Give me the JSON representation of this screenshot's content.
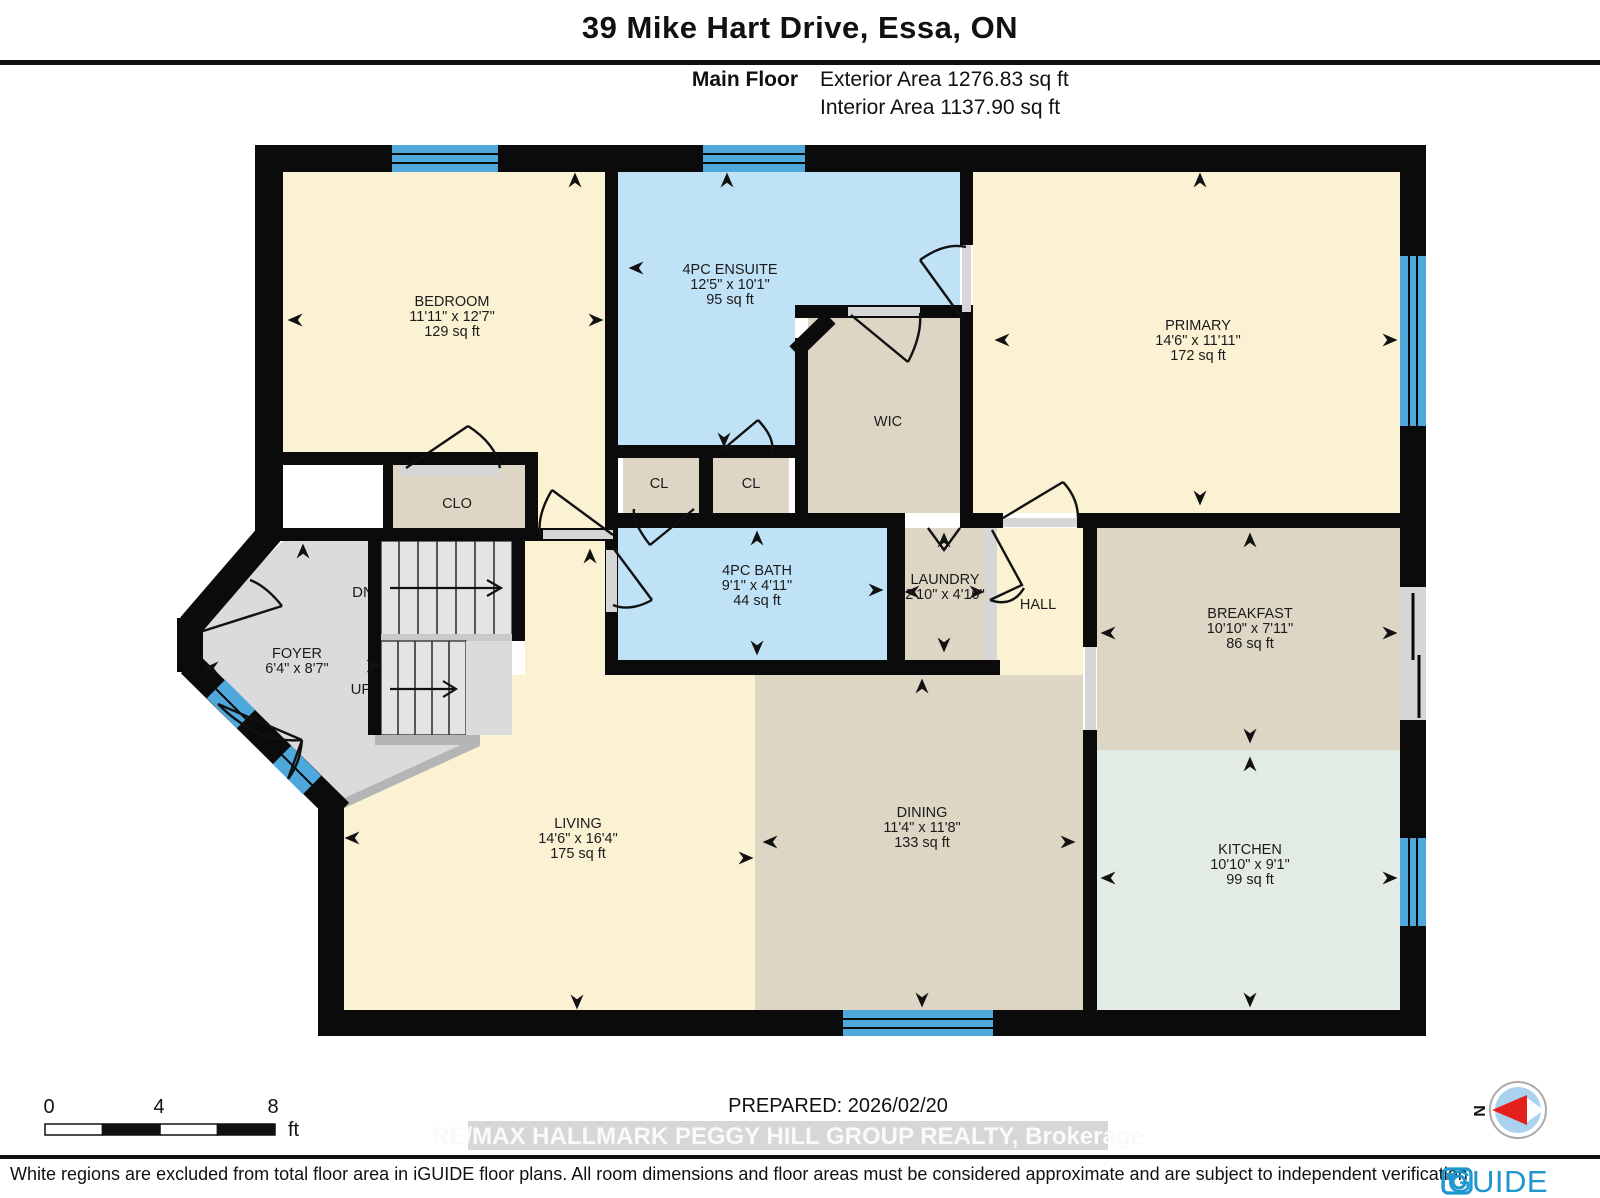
{
  "header": {
    "title": "39 Mike Hart Drive, Essa, ON",
    "floor_label": "Main Floor",
    "exterior_area": "Exterior Area 1276.83 sq ft",
    "interior_area": "Interior Area 1137.90 sq ft"
  },
  "rooms": {
    "bedroom": {
      "name": "BEDROOM",
      "dims": "11'11\" x 12'7\"",
      "area": "129 sq ft"
    },
    "ensuite": {
      "name": "4PC ENSUITE",
      "dims": "12'5\" x 10'1\"",
      "area": "95 sq ft"
    },
    "primary": {
      "name": "PRIMARY",
      "dims": "14'6\" x 11'11\"",
      "area": "172 sq ft"
    },
    "wic": {
      "name": "WIC"
    },
    "clo": {
      "name": "CLO"
    },
    "cl_left": {
      "name": "CL"
    },
    "cl_right": {
      "name": "CL"
    },
    "bath": {
      "name": "4PC BATH",
      "dims": "9'1\" x 4'11\"",
      "area": "44 sq ft"
    },
    "laundry": {
      "name": "LAUNDRY",
      "dims": "2'10\" x 4'10\""
    },
    "hall": {
      "name": "HALL"
    },
    "foyer": {
      "name": "FOYER",
      "dims": "6'4\" x 8'7\""
    },
    "breakfast": {
      "name": "BREAKFAST",
      "dims": "10'10\" x 7'11\"",
      "area": "86 sq ft"
    },
    "kitchen": {
      "name": "KITCHEN",
      "dims": "10'10\" x 9'1\"",
      "area": "99 sq ft"
    },
    "living": {
      "name": "LIVING",
      "dims": "14'6\" x 16'4\"",
      "area": "175 sq ft"
    },
    "dining": {
      "name": "DINING",
      "dims": "11'4\" x 11'8\"",
      "area": "133 sq ft"
    }
  },
  "stairs": {
    "down": "DN",
    "up": "UP"
  },
  "scale_bar": {
    "ticks": [
      "0",
      "4",
      "8"
    ],
    "unit": "ft"
  },
  "prepared_label": "PREPARED: 2026/02/20",
  "watermark": "RE/MAX HALLMARK PEGGY HILL GROUP REALTY, Brokerage",
  "compass": {
    "north_label": "N"
  },
  "footer": {
    "disclaimer": "White regions are excluded from total floor area in iGUIDE floor plans. All room dimensions and floor areas must be considered approximate and are subject to independent verification.",
    "brand": "iGUIDE"
  },
  "colors": {
    "room_cream": "#FBF1D3",
    "room_blue": "#BFE2F7",
    "room_beige": "#DED6C5",
    "room_mint": "#E2ECE4",
    "room_gray": "#DBDBDB",
    "window_blue": "#4FA8DC",
    "wall_black": "#0B0B0B",
    "logo_blue": "#1E97CE",
    "compass_red": "#E3211A"
  }
}
